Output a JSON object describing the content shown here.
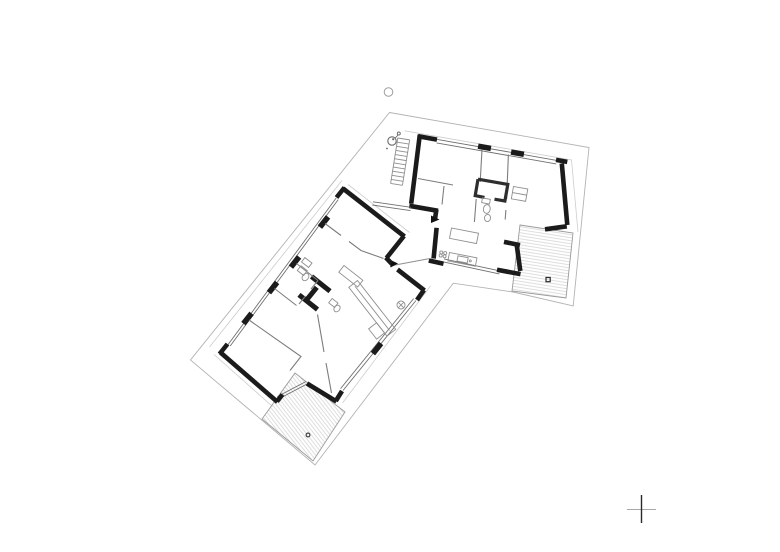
{
  "document": {
    "kind": "architectural floor plan drawing",
    "sheet": "white sheet, no visible text labels",
    "wings": [
      {
        "name": "upper-wing",
        "rotation_deg": 10,
        "features": [
          "glazed top wall with two piers",
          "exterior stair at west wall",
          "kitchen counter with sink and 4-burner hob",
          "central bathroom block",
          "dining table",
          "wardrobe",
          "timber deck terrace with drain mark"
        ]
      },
      {
        "name": "lower-wing",
        "rotation_deg": 39,
        "features": [
          "glazed northwest wall with four piers",
          "fireplace core",
          "bathroom fixtures",
          "long sideboard",
          "shower drain symbol",
          "timber deck terrace with drain mark"
        ]
      }
    ],
    "connector": "glazed link with recessed entrance between wings"
  },
  "symbols": {
    "entrance_arrow_upper": "black triangle pointing into upper wing",
    "entrance_arrow_lower": "black triangle pointing into lower wing",
    "tree_symbol": "small circle with offset dot",
    "survey_circle": "small open circle north of plan",
    "deck_drain_upper": "small open square on upper terrace",
    "deck_drain_lower": "small open circle on lower terrace",
    "crop_mark": "registration cross at lower right"
  },
  "colors": {
    "bg": "#ffffff",
    "wall": "#1b1b1b",
    "wall2": "#2e2e2e",
    "partition": "#7d7d7d",
    "fixture": "#8f8f8f",
    "window": "#6f6f6f",
    "boundary": "#b3b3b3",
    "eaves": "#cdcdcd",
    "terrace": "#9a9a9a",
    "hatch": "#d0d0d0",
    "arrow": "#111111",
    "tree": "#6a6a6a",
    "mark_v": "#2a2a2a",
    "mark_h": "#a8a8a8",
    "circle": "#9e9e9e"
  }
}
